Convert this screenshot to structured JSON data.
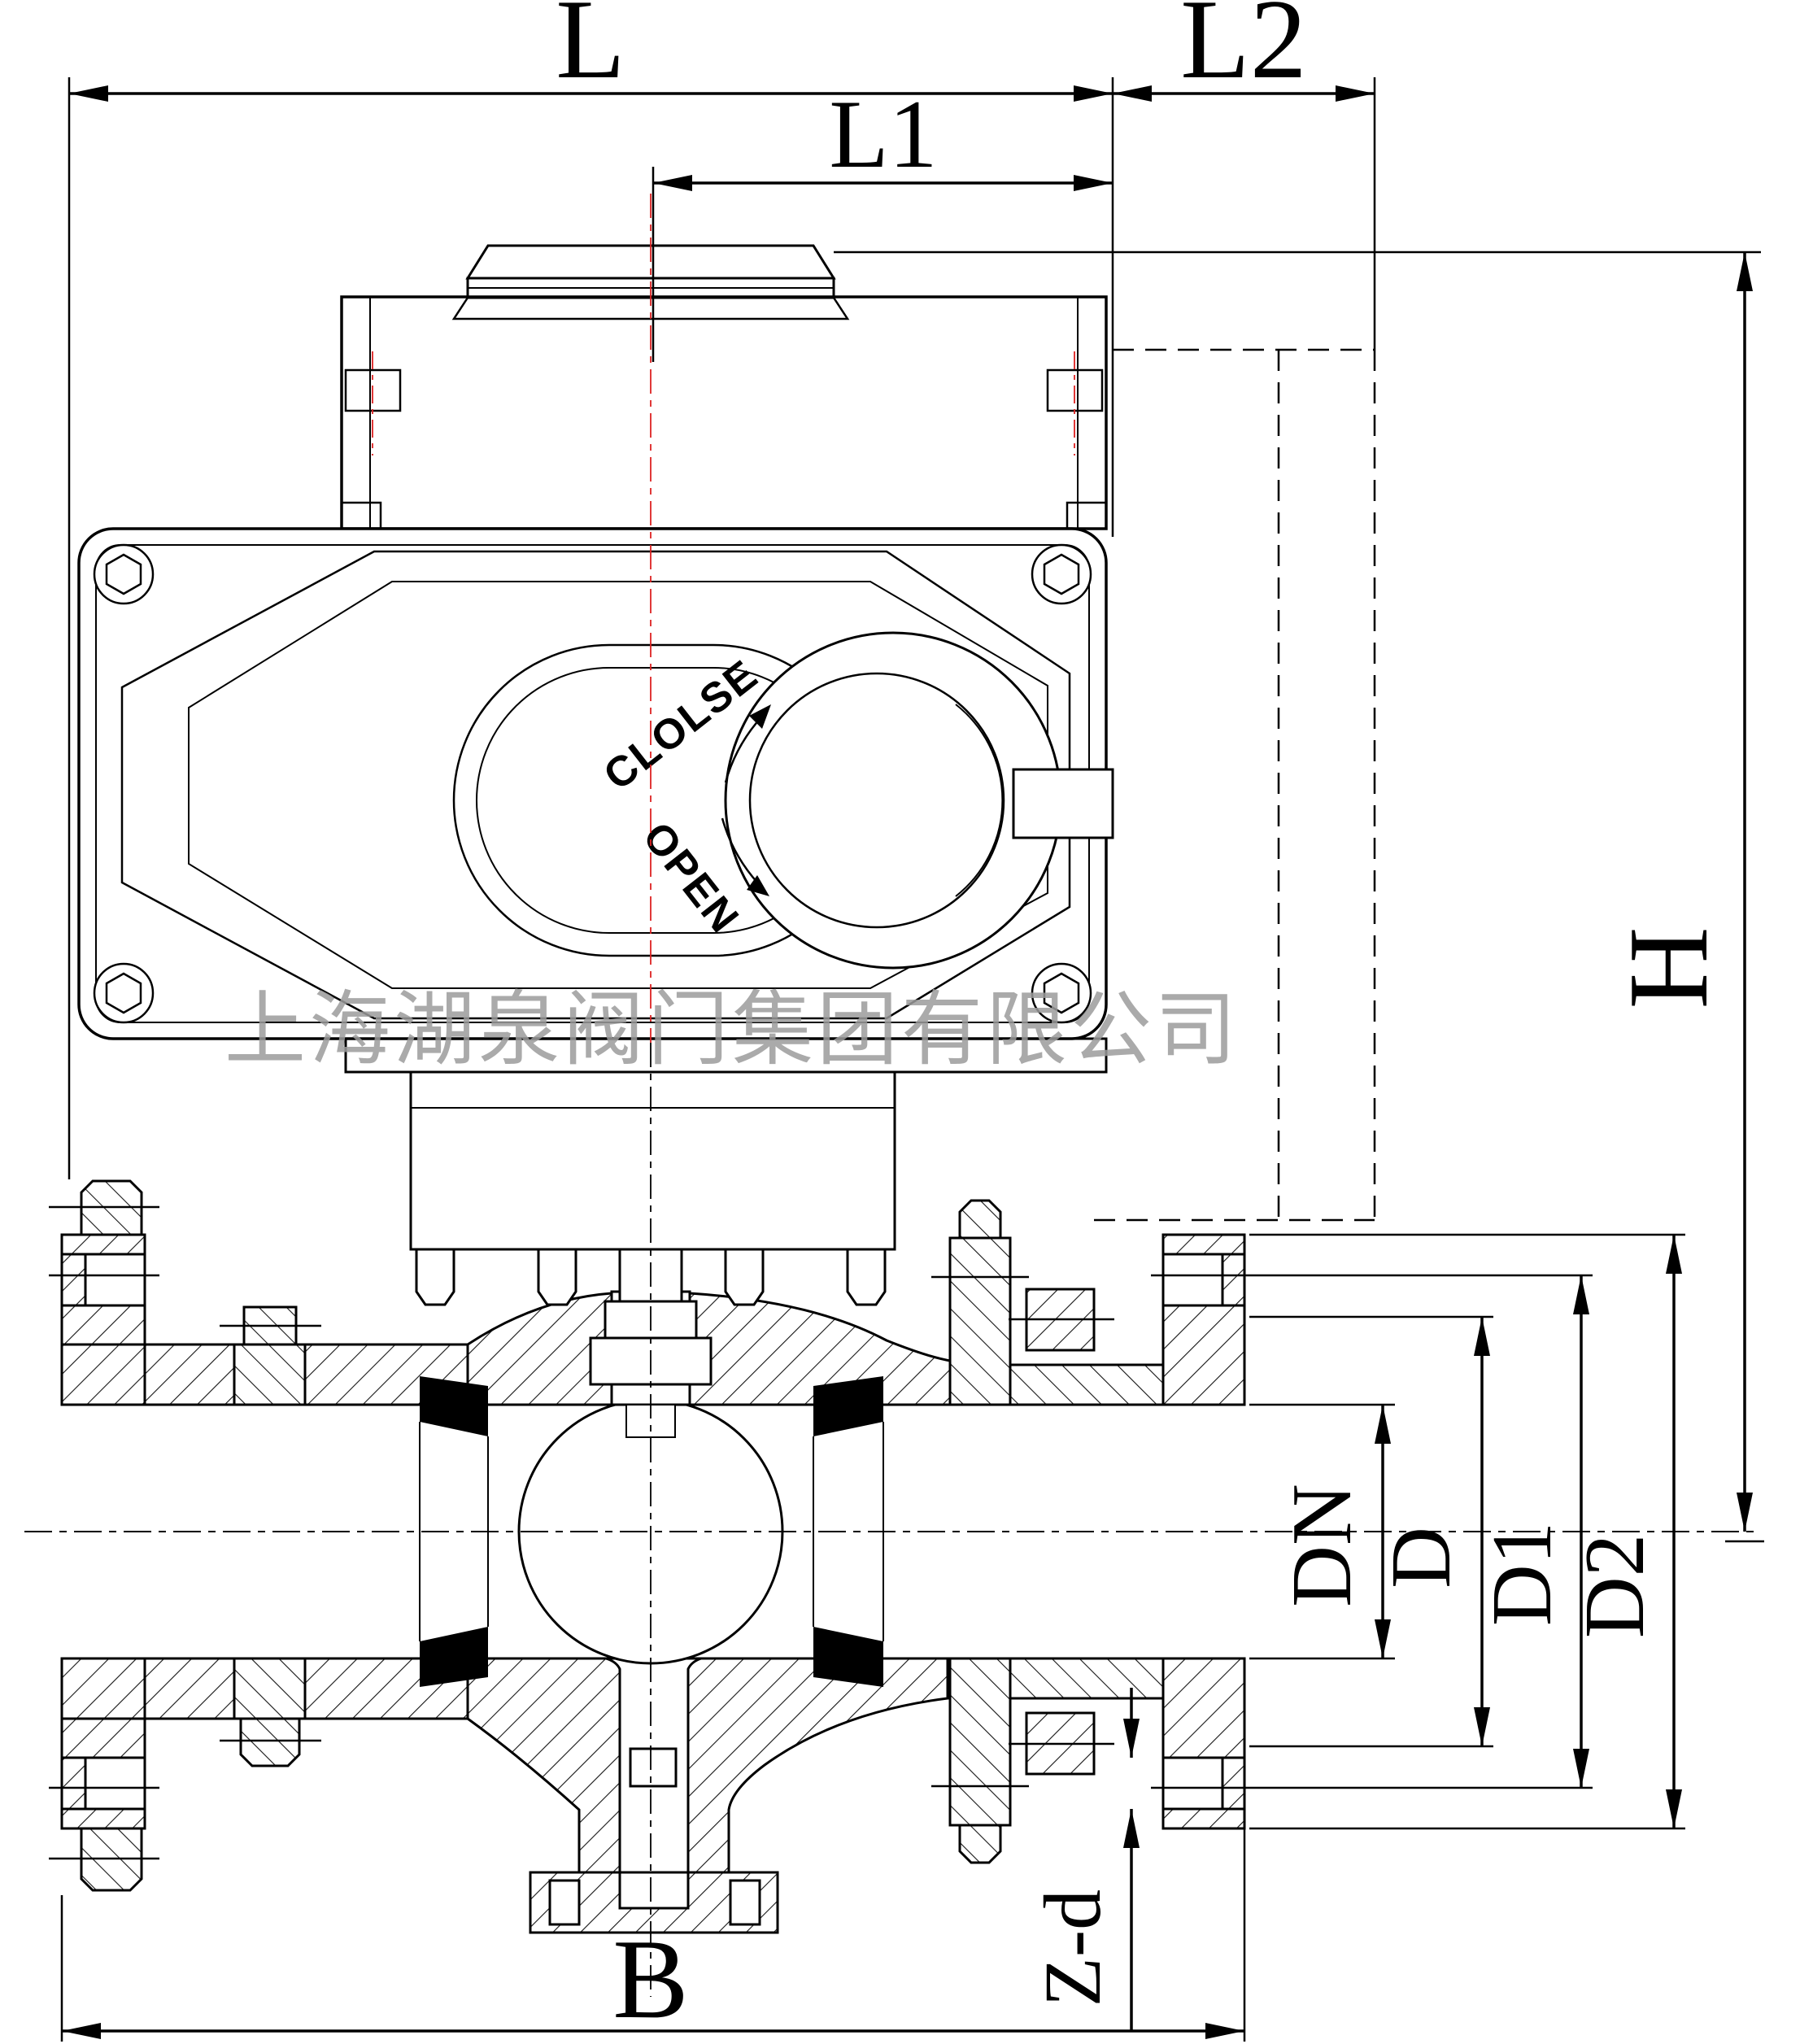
{
  "drawing": {
    "type": "engineering-dimension-drawing",
    "subject": "electric actuated flanged ball valve, cross-section",
    "dimensions": {
      "l": "L",
      "l1": "L1",
      "l2": "L2",
      "h": "H",
      "dn": "DN",
      "d": "D",
      "d1": "D1",
      "d2": "D2",
      "b": "B",
      "zd": "Z-d"
    },
    "actuator": {
      "close_label": "CLOLSE",
      "open_label": "OPEN"
    },
    "watermark": "上海湖泉阀门集团有限公司",
    "colors": {
      "line": "#000000",
      "centerline_red": "#dd2222",
      "seat": "#000000",
      "watermark": "#9c9c9c",
      "background": "#ffffff"
    }
  }
}
